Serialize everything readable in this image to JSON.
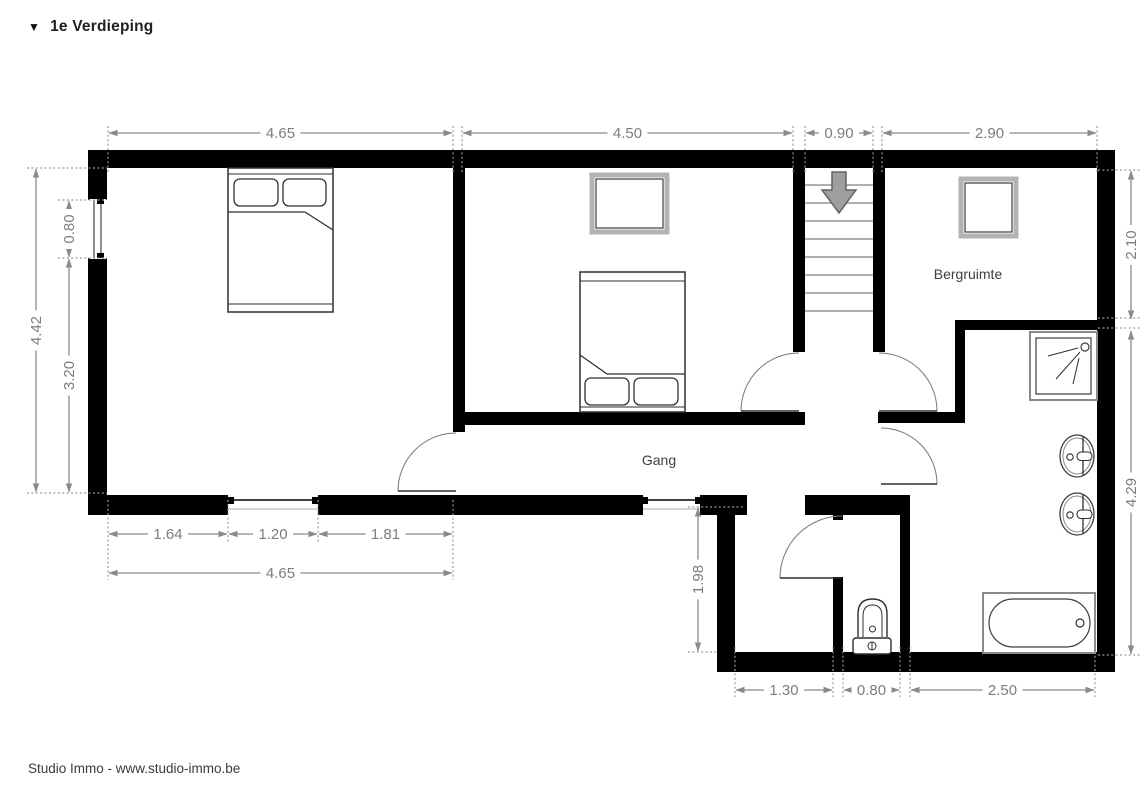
{
  "title": {
    "icon": "▼",
    "text": "1e Verdieping"
  },
  "footer": {
    "text": "Studio Immo - www.studio-immo.be"
  },
  "colors": {
    "wall": "#000000",
    "dim_line": "#8a8a8a",
    "dim_text": "#7d7d7d",
    "room_label": "#3f3f3f",
    "tread": "#b0b0b0",
    "arrow_fill": "#9e9e9e",
    "arrow_stroke": "#5f6368",
    "door_arc": "#777777",
    "stroke_dark": "#2f2f2f"
  },
  "rooms": [
    {
      "name": "room-label-bergruimte",
      "label": "Bergruimte",
      "x": 968,
      "y": 279
    },
    {
      "name": "room-label-gang",
      "label": "Gang",
      "x": 659,
      "y": 465
    }
  ],
  "plan": {
    "walls": [
      [
        88,
        150,
        1027,
        18
      ],
      [
        88,
        150,
        19,
        50
      ],
      [
        88,
        258,
        19,
        257
      ],
      [
        88,
        495,
        140,
        20
      ],
      [
        318,
        495,
        325,
        20
      ],
      [
        700,
        495,
        47,
        20
      ],
      [
        805,
        495,
        105,
        20
      ],
      [
        717,
        515,
        18,
        140
      ],
      [
        717,
        652,
        398,
        20
      ],
      [
        1097,
        150,
        18,
        522
      ],
      [
        453,
        168,
        12,
        264
      ],
      [
        462,
        412,
        343,
        13
      ],
      [
        793,
        168,
        12,
        184
      ],
      [
        873,
        168,
        12,
        184
      ],
      [
        878,
        412,
        87,
        11
      ],
      [
        955,
        320,
        10,
        103
      ],
      [
        955,
        320,
        160,
        10
      ],
      [
        833,
        495,
        10,
        25
      ],
      [
        833,
        577,
        10,
        78
      ],
      [
        900,
        495,
        10,
        160
      ]
    ],
    "windows": [
      {
        "name": "window-bedroom1-left",
        "prims": [
          {
            "t": "rect",
            "x": 89,
            "y": 199,
            "w": 17,
            "h": 60,
            "f": "#ffffff",
            "s": "none"
          },
          {
            "t": "line",
            "x1": 94,
            "y1": 200,
            "x2": 94,
            "y2": 258,
            "s": "#444444",
            "sw": 1.2
          },
          {
            "t": "line",
            "x1": 101,
            "y1": 200,
            "x2": 101,
            "y2": 258,
            "s": "#444444",
            "sw": 1.2
          },
          {
            "t": "rect",
            "x": 97,
            "y": 199,
            "w": 7,
            "h": 5,
            "f": "#000000",
            "s": "none"
          },
          {
            "t": "rect",
            "x": 97,
            "y": 253,
            "w": 7,
            "h": 5,
            "f": "#000000",
            "s": "none"
          }
        ]
      },
      {
        "name": "window-bedroom1-bottom",
        "prims": [
          {
            "t": "line",
            "x1": 228,
            "y1": 500,
            "x2": 318,
            "y2": 500,
            "s": "#000000",
            "sw": 1.4
          },
          {
            "t": "line",
            "x1": 228,
            "y1": 509,
            "x2": 318,
            "y2": 509,
            "s": "#aaaaaa",
            "sw": 1
          },
          {
            "t": "rect",
            "x": 228,
            "y": 497,
            "w": 6,
            "h": 7,
            "f": "#000000",
            "s": "none"
          },
          {
            "t": "rect",
            "x": 312,
            "y": 497,
            "w": 6,
            "h": 7,
            "f": "#000000",
            "s": "none"
          }
        ]
      },
      {
        "name": "window-hall-bottom",
        "prims": [
          {
            "t": "line",
            "x1": 643,
            "y1": 500,
            "x2": 700,
            "y2": 500,
            "s": "#000000",
            "sw": 1.4
          },
          {
            "t": "line",
            "x1": 643,
            "y1": 509,
            "x2": 700,
            "y2": 509,
            "s": "#aaaaaa",
            "sw": 1
          },
          {
            "t": "rect",
            "x": 643,
            "y": 497,
            "w": 5,
            "h": 7,
            "f": "#000000",
            "s": "none"
          },
          {
            "t": "rect",
            "x": 695,
            "y": 497,
            "w": 5,
            "h": 7,
            "f": "#000000",
            "s": "none"
          }
        ]
      }
    ],
    "doors": [
      {
        "name": "door-bedroom-1",
        "leaf": [
          456,
          491,
          398,
          491
        ],
        "arc": "M398,491 A58,58 0 0 1 456,433"
      },
      {
        "name": "door-bedroom-2",
        "leaf": [
          799,
          411,
          741,
          411
        ],
        "arc": "M741,411 A58,58 0 0 1 799,353"
      },
      {
        "name": "door-storage",
        "leaf": [
          879,
          411,
          937,
          411
        ],
        "arc": "M937,411 A58,58 0 0 0 879,353"
      },
      {
        "name": "door-bathroom",
        "leaf": [
          881,
          484,
          937,
          484
        ],
        "arc": "M937,484 A56,56 0 0 0 881,428"
      },
      {
        "name": "door-wc",
        "leaf": [
          842,
          578,
          780,
          578
        ],
        "arc": "M780,578 A62,62 0 0 1 842,516"
      }
    ],
    "stairs": {
      "x1": 805,
      "x2": 873,
      "treads": [
        185,
        203,
        221,
        239,
        257,
        275,
        293,
        311
      ],
      "arrow_path": "M832,172 L846,172 L846,190 L856,190 L839,213 L822,190 L832,190 Z"
    },
    "furniture": [
      {
        "name": "bed-master",
        "prims": [
          {
            "t": "rect",
            "x": 228,
            "y": 168,
            "w": 105,
            "h": 144,
            "f": "#ffffff",
            "sw": 1.5
          },
          {
            "t": "line",
            "x1": 228,
            "y1": 174,
            "x2": 333,
            "y2": 174,
            "sw": 1
          },
          {
            "t": "rect",
            "x": 234,
            "y": 179,
            "w": 44,
            "h": 27,
            "rx": 6
          },
          {
            "t": "rect",
            "x": 283,
            "y": 179,
            "w": 43,
            "h": 27,
            "rx": 6
          },
          {
            "t": "line",
            "x1": 228,
            "y1": 212,
            "x2": 305,
            "y2": 212
          },
          {
            "t": "line",
            "x1": 305,
            "y1": 212,
            "x2": 333,
            "y2": 230
          },
          {
            "t": "line",
            "x1": 228,
            "y1": 304,
            "x2": 333,
            "y2": 304,
            "sw": 1
          }
        ]
      },
      {
        "name": "bed-second",
        "prims": [
          {
            "t": "rect",
            "x": 580,
            "y": 272,
            "w": 105,
            "h": 140,
            "f": "#ffffff",
            "sw": 1.5
          },
          {
            "t": "line",
            "x1": 580,
            "y1": 281,
            "x2": 685,
            "y2": 281,
            "sw": 1
          },
          {
            "t": "line",
            "x1": 580,
            "y1": 355,
            "x2": 607,
            "y2": 374
          },
          {
            "t": "line",
            "x1": 607,
            "y1": 374,
            "x2": 685,
            "y2": 374
          },
          {
            "t": "rect",
            "x": 585,
            "y": 378,
            "w": 44,
            "h": 27,
            "rx": 6
          },
          {
            "t": "rect",
            "x": 634,
            "y": 378,
            "w": 44,
            "h": 27,
            "rx": 6
          },
          {
            "t": "line",
            "x1": 580,
            "y1": 407,
            "x2": 685,
            "y2": 407,
            "sw": 1
          }
        ]
      },
      {
        "name": "wardrobe-bedroom-2",
        "prims": [
          {
            "t": "rect",
            "x": 592,
            "y": 175,
            "w": 75,
            "h": 57,
            "s": "#b3b3b3",
            "sw": 5,
            "f": "#ffffff"
          },
          {
            "t": "rect",
            "x": 596,
            "y": 179,
            "w": 67,
            "h": 49,
            "s": "#3c3c3c",
            "sw": 1.2
          }
        ]
      },
      {
        "name": "cabinet-storage",
        "prims": [
          {
            "t": "rect",
            "x": 961,
            "y": 179,
            "w": 55,
            "h": 57,
            "s": "#b3b3b3",
            "sw": 5,
            "f": "#ffffff"
          },
          {
            "t": "rect",
            "x": 965,
            "y": 183,
            "w": 47,
            "h": 49,
            "s": "#3c3c3c",
            "sw": 1.2
          }
        ]
      },
      {
        "name": "shower",
        "prims": [
          {
            "t": "rect",
            "x": 1030,
            "y": 332,
            "w": 67,
            "h": 68,
            "s": "#8a8a8a",
            "sw": 2,
            "f": "#ffffff"
          },
          {
            "t": "rect",
            "x": 1036,
            "y": 338,
            "w": 55,
            "h": 56,
            "s": "#3c3c3c",
            "sw": 1.2
          },
          {
            "t": "circle",
            "cx": 1085,
            "cy": 347,
            "r": 4,
            "s": "#3c3c3c",
            "sw": 1.2
          },
          {
            "t": "line",
            "x1": 1078,
            "y1": 348,
            "x2": 1048,
            "y2": 356,
            "sw": 1
          },
          {
            "t": "line",
            "x1": 1080,
            "y1": 352,
            "x2": 1056,
            "y2": 379,
            "sw": 1
          },
          {
            "t": "line",
            "x1": 1079,
            "y1": 358,
            "x2": 1073,
            "y2": 384,
            "sw": 1
          }
        ]
      },
      {
        "name": "sink-1",
        "prims": [
          {
            "t": "ellipse",
            "cx": 1077,
            "cy": 456,
            "rx": 17,
            "ry": 21,
            "s": "#3c3c3c",
            "sw": 1.3,
            "f": "#ffffff"
          },
          {
            "t": "ellipse",
            "cx": 1077,
            "cy": 456,
            "rx": 14,
            "ry": 18,
            "s": "#8a8a8a",
            "sw": 1
          },
          {
            "t": "line",
            "x1": 1083,
            "y1": 437,
            "x2": 1083,
            "y2": 475
          },
          {
            "t": "circle",
            "cx": 1070,
            "cy": 457,
            "r": 3.2,
            "sw": 1.1
          },
          {
            "t": "rect",
            "x": 1077,
            "y": 452,
            "w": 15,
            "h": 8.5,
            "rx": 4,
            "f": "#ffffff",
            "sw": 1.1
          }
        ]
      },
      {
        "name": "sink-2",
        "prims": [
          {
            "t": "ellipse",
            "cx": 1077,
            "cy": 514,
            "rx": 17,
            "ry": 21,
            "s": "#3c3c3c",
            "sw": 1.3,
            "f": "#ffffff"
          },
          {
            "t": "ellipse",
            "cx": 1077,
            "cy": 514,
            "rx": 14,
            "ry": 18,
            "s": "#8a8a8a",
            "sw": 1
          },
          {
            "t": "line",
            "x1": 1083,
            "y1": 495,
            "x2": 1083,
            "y2": 533
          },
          {
            "t": "circle",
            "cx": 1070,
            "cy": 515,
            "r": 3.2,
            "sw": 1.1
          },
          {
            "t": "rect",
            "x": 1077,
            "y": 510,
            "w": 15,
            "h": 8.5,
            "rx": 4,
            "f": "#ffffff",
            "sw": 1.1
          }
        ]
      },
      {
        "name": "toilet",
        "prims": [
          {
            "t": "path",
            "d": "M858,637 L858,614 Q858,599 872.5,599 Q887,599 887,614 L887,637",
            "sw": 1.4,
            "f": "#ffffff"
          },
          {
            "t": "path",
            "d": "M863,637 L863,616 Q863,605 872.5,605 Q882,605 882,616 L882,637",
            "sw": 1
          },
          {
            "t": "circle",
            "cx": 872.5,
            "cy": 629,
            "r": 3,
            "sw": 1
          },
          {
            "t": "rect",
            "x": 853,
            "y": 638,
            "w": 38,
            "h": 16,
            "rx": 3,
            "f": "#ffffff",
            "sw": 1.4
          },
          {
            "t": "circle",
            "cx": 872,
            "cy": 646,
            "r": 4,
            "sw": 1
          },
          {
            "t": "line",
            "x1": 872,
            "y1": 642,
            "x2": 872,
            "y2": 650,
            "sw": 1
          }
        ]
      },
      {
        "name": "bathtub",
        "prims": [
          {
            "t": "rect",
            "x": 983,
            "y": 593,
            "w": 112,
            "h": 60,
            "s": "#8a8a8a",
            "sw": 2,
            "f": "#ffffff"
          },
          {
            "t": "rect",
            "x": 989,
            "y": 599,
            "w": 101,
            "h": 48,
            "rx": 24,
            "s": "#3c3c3c",
            "sw": 1.2,
            "f": "#ffffff"
          },
          {
            "t": "circle",
            "cx": 1080,
            "cy": 623,
            "r": 4,
            "sw": 1.2
          }
        ]
      }
    ],
    "dimensions": {
      "horizontal": [
        {
          "x1": 108,
          "x2": 453,
          "y": 133,
          "label": "4.65"
        },
        {
          "x1": 462,
          "x2": 793,
          "y": 133,
          "label": "4.50"
        },
        {
          "x1": 805,
          "x2": 873,
          "y": 133,
          "label": "0.90"
        },
        {
          "x1": 882,
          "x2": 1097,
          "y": 133,
          "label": "2.90"
        },
        {
          "x1": 108,
          "x2": 228,
          "y": 534,
          "label": "1.64"
        },
        {
          "x1": 228,
          "x2": 318,
          "y": 534,
          "label": "1.20"
        },
        {
          "x1": 318,
          "x2": 453,
          "y": 534,
          "label": "1.81"
        },
        {
          "x1": 108,
          "x2": 453,
          "y": 573,
          "label": "4.65"
        },
        {
          "x1": 735,
          "x2": 833,
          "y": 690,
          "label": "1.30"
        },
        {
          "x1": 843,
          "x2": 900,
          "y": 690,
          "label": "0.80"
        },
        {
          "x1": 910,
          "x2": 1095,
          "y": 690,
          "label": "2.50"
        }
      ],
      "vertical": [
        {
          "y1": 168,
          "y2": 493,
          "x": 36,
          "label": "4.42"
        },
        {
          "y1": 200,
          "y2": 258,
          "x": 69,
          "label": "0.80"
        },
        {
          "y1": 258,
          "y2": 493,
          "x": 69,
          "label": "3.20"
        },
        {
          "y1": 170,
          "y2": 320,
          "x": 1131,
          "label": "2.10"
        },
        {
          "y1": 330,
          "y2": 655,
          "x": 1131,
          "label": "4.29"
        },
        {
          "y1": 507,
          "y2": 652,
          "x": 698,
          "label": "1.98"
        }
      ],
      "extensions": [
        [
          108,
          126,
          108,
          174
        ],
        [
          453,
          126,
          453,
          174
        ],
        [
          462,
          126,
          462,
          174
        ],
        [
          793,
          126,
          793,
          174
        ],
        [
          805,
          126,
          805,
          174
        ],
        [
          873,
          126,
          873,
          174
        ],
        [
          882,
          126,
          882,
          174
        ],
        [
          1097,
          126,
          1097,
          174
        ],
        [
          27,
          168,
          107,
          168
        ],
        [
          58,
          200,
          107,
          200
        ],
        [
          58,
          258,
          107,
          258
        ],
        [
          27,
          493,
          107,
          493
        ],
        [
          108,
          500,
          108,
          580
        ],
        [
          228,
          500,
          228,
          542
        ],
        [
          318,
          500,
          318,
          542
        ],
        [
          453,
          500,
          453,
          580
        ],
        [
          688,
          507,
          745,
          507
        ],
        [
          688,
          652,
          716,
          652
        ],
        [
          735,
          647,
          735,
          697
        ],
        [
          833,
          647,
          833,
          697
        ],
        [
          843,
          647,
          843,
          697
        ],
        [
          900,
          647,
          900,
          697
        ],
        [
          910,
          647,
          910,
          697
        ],
        [
          1095,
          647,
          1095,
          697
        ],
        [
          1098,
          170,
          1140,
          170
        ],
        [
          1098,
          318,
          1140,
          318
        ],
        [
          1098,
          328,
          1140,
          328
        ],
        [
          1098,
          655,
          1140,
          655
        ]
      ]
    }
  }
}
